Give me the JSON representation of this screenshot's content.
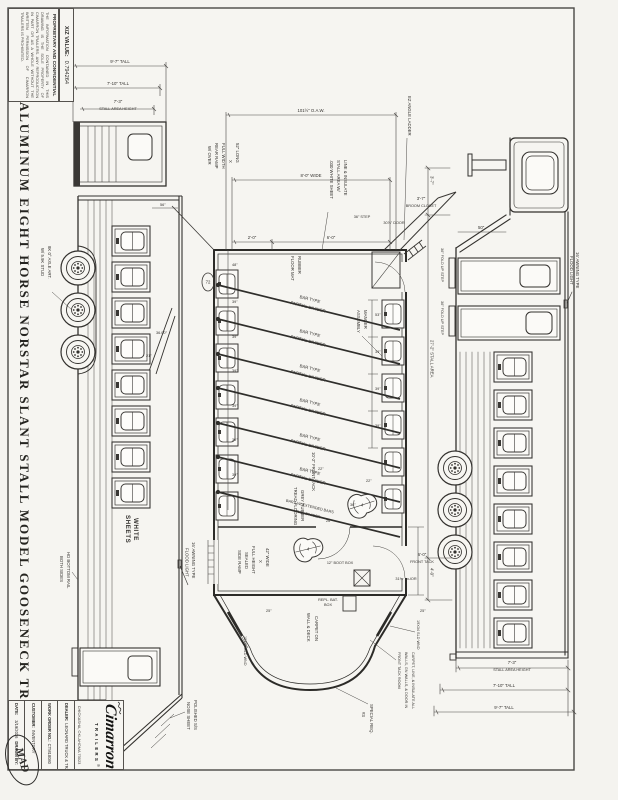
{
  "sheet": {
    "xz_label": "X/Z VALUE:",
    "xz_value": "0.794264",
    "proprietary_title": "PROPRIETARY AND CONFIDENTIAL",
    "proprietary_body": "THE INFORMATION CONTAINED IN THIS DRAWING IS THE SOLE PROPERTY OF CIMARRON TRAILERS. ANY REPRODUCTION IN PART OR AS A WHOLE WITHOUT THE WRITTEN PERMISSION OF CIMARRON TRAILERS IS PROHIBITED.",
    "title": "ALUMINUM EIGHT HORSE NORSTAR SLANT STALL MODEL GOOSENECK TRAILER"
  },
  "title_block": {
    "brand": "Cimarron",
    "brand_sub": "TRAILERS",
    "brand_reg": "®",
    "city": "CHICKASHA, OKLAHOMA 73023",
    "dealer_label": "DEALER:",
    "dealer_value": "LEONARD TRUCK & TRAILER",
    "work_order_label": "WORK ORDER NO.:",
    "work_order_value": "CTM18080",
    "customer_label": "CUSTOMER:",
    "customer_value": "INVENTORY",
    "date_label": "DATE:",
    "date_value": "3/19/2026",
    "drawn_label": "DRAWN BY:",
    "approval_note": "MAD"
  },
  "heights": {
    "stall_height": "7'-3\"",
    "stall_height_caption": "STALL AREA HEIGHT",
    "mid": "7'-10\" TALL",
    "overall": "9'-7\" TALL"
  },
  "curb_view": {
    "awning_l1": "16' AWNING TYPE",
    "awning_l2": "FLOOD LIGHT",
    "step": "36\" FOLD UP STEP",
    "dim_hitch": "3'-7\"",
    "dim_stall_len": "27'-2\" STALL AREA",
    "dim_front": "4'-0\"",
    "dim_drop": "50\""
  },
  "plan_view": {
    "oaw": "101½\" O.A.W.",
    "wide": "8'-0\" WIDE",
    "d6": "6'-0\"",
    "d2": "2'-0\"",
    "ladder": "EZ ANGLE LADDER",
    "ramp_l1": "52\" LONG",
    "ramp_l2": "X",
    "ramp_l3": "FULL WIDTH",
    "ramp_l4": "REAR RAMP",
    "ramp_l5": "W/ OVER",
    "mat_l1": "RUBBER",
    "mat_l2": "FLOOR MAT",
    "insulate_l1": "LINE & INSULATE",
    "insulate_l2": "STALL AREA W/",
    "insulate_l3": ".030 WHITE SHEET",
    "divider_l1": "BAR TYPE",
    "divider_l2": "PARTIAL DIVIDER",
    "full_divider_l1": "BARS W/ EXTENDED BARS",
    "full_divider_l2": "FULL DIVIDER",
    "manger_l1": "MANGER",
    "manger_l2": "ASSEMBLY",
    "broom_dim": "3'-7\"",
    "broom_label": "BROOM CLOSET",
    "door_rear": "30⅞\" DOOR",
    "step_rear": "36\" STEP",
    "front_tack_len": "10'-2\" FRONT TACK",
    "front_tack_dim": "6'-0\"",
    "front_tack_word": "FRONT TACK",
    "door_front": "31¾\" DOOR",
    "tread_l1": "GREY RUBBER",
    "tread_l2": "TREAD FLOORING",
    "side_ramp_l1": "42\" WIDE",
    "side_ramp_l2": "X",
    "side_ramp_l3": "FULL HEIGHT",
    "side_ramp_l4": "SEALED",
    "side_ramp_l5": "SIDE RAMP",
    "boot_box": "12\" BOOT BOX",
    "carpet_l1": "CARPET ON",
    "carpet_l2": "WALL & DECK",
    "sld_wnd": "19X34 SLD WND",
    "bat_l1": "REPL. BAT.",
    "bat_l2": "BOX",
    "special_l1": "SPECIAL REQ.",
    "special_l2": "#3",
    "note_l1": "CARPET, LINE, & INSULATE ALL",
    "note_l2": "WALLS, GN WALLS, & DOOR IN",
    "note_l3": "FRONT TACK ROOM",
    "rack_count": "4",
    "dims": {
      "d48": "48\"",
      "d39": "39\"",
      "d53": "53\"",
      "d72": "72",
      "d22": "22\"",
      "d25": "25\"",
      "d26": "26\"",
      "d36": "36\""
    }
  },
  "road_view": {
    "white_l1": "WHITE",
    "white_l2": "SHEETS",
    "awning_l1": "16' AWNING TYPE",
    "awning_l2": "FLOOD LIGHT",
    "axle_l1": "8K 0° AXLE ART.",
    "axle_l2": "W/ 5.9K STUD",
    "angle": "36.00°",
    "d21": "21\"",
    "d56": "56\"",
    "nose_l1": "POLISHED S/S",
    "nose_l2": "NOSE SHEET",
    "rail_l1": "HD BOTTOM RAIL",
    "rail_l2": "BOTH SIDES"
  }
}
